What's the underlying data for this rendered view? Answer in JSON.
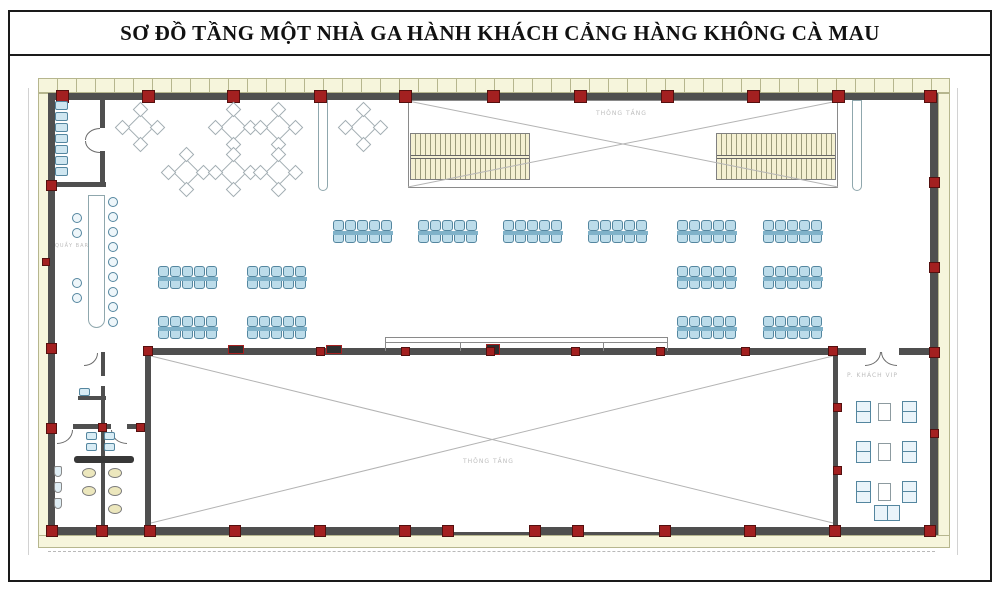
{
  "title": "SƠ ĐỒ TẦNG MỘT NHÀ GA HÀNH KHÁCH CẢNG HÀNG KHÔNG CÀ MAU",
  "colors": {
    "wall": "#4f4f4f",
    "column": "#a32020",
    "column_border": "#55100f",
    "band": "#f6f5dc",
    "band_border": "#b6b68e",
    "seat_fill": "#bcdcea",
    "seat_border": "#54869f",
    "seat_bar": "#80b2c9",
    "table_line": "#a2adb2",
    "stair_fill": "#f4f0d2",
    "stair_line": "#9a9a7a",
    "diagonal": "#b3b3b3",
    "label": "#bdbdbd"
  },
  "labels": [
    {
      "text": "THÔNG TẦNG",
      "x": 596,
      "y": 110,
      "size": 6
    },
    {
      "text": "THÔNG TẦNG",
      "x": 463,
      "y": 458,
      "size": 6
    },
    {
      "text": "P. KHÁCH VIP",
      "x": 847,
      "y": 372,
      "size": 6
    },
    {
      "text": "QUẦY BAR",
      "x": 55,
      "y": 243,
      "size": 5
    }
  ],
  "plan": {
    "benches": [
      [
        333,
        220
      ],
      [
        418,
        220
      ],
      [
        503,
        220
      ],
      [
        588,
        220
      ],
      [
        677,
        220
      ],
      [
        763,
        220
      ],
      [
        158,
        266
      ],
      [
        247,
        266
      ],
      [
        677,
        266
      ],
      [
        763,
        266
      ],
      [
        158,
        316
      ],
      [
        247,
        316
      ],
      [
        677,
        316
      ],
      [
        763,
        316
      ]
    ],
    "cafe_tables": [
      [
        140,
        127
      ],
      [
        233,
        127
      ],
      [
        278,
        127
      ],
      [
        363,
        127
      ],
      [
        186,
        172
      ],
      [
        233,
        172
      ],
      [
        278,
        172
      ]
    ],
    "columns": [
      [
        62,
        96,
        13
      ],
      [
        148,
        96,
        13
      ],
      [
        233,
        96,
        13
      ],
      [
        320,
        96,
        13
      ],
      [
        405,
        96,
        13
      ],
      [
        493,
        96,
        13
      ],
      [
        580,
        96,
        13
      ],
      [
        667,
        96,
        13
      ],
      [
        753,
        96,
        13
      ],
      [
        838,
        96,
        13
      ],
      [
        930,
        96,
        13
      ],
      [
        52,
        531,
        12
      ],
      [
        102,
        531,
        12
      ],
      [
        150,
        531,
        12
      ],
      [
        235,
        531,
        12
      ],
      [
        320,
        531,
        12
      ],
      [
        405,
        531,
        12
      ],
      [
        448,
        531,
        12
      ],
      [
        535,
        531,
        12
      ],
      [
        578,
        531,
        12
      ],
      [
        665,
        531,
        12
      ],
      [
        750,
        531,
        12
      ],
      [
        835,
        531,
        12
      ],
      [
        930,
        531,
        12
      ],
      [
        51,
        185,
        11
      ],
      [
        46,
        262,
        8
      ],
      [
        51,
        348,
        11
      ],
      [
        51,
        428,
        11
      ],
      [
        934,
        182,
        11
      ],
      [
        934,
        267,
        11
      ],
      [
        934,
        352,
        11
      ],
      [
        934,
        433,
        9
      ],
      [
        837,
        407,
        9
      ],
      [
        837,
        470,
        9
      ],
      [
        148,
        351,
        10
      ],
      [
        320,
        351,
        9
      ],
      [
        405,
        351,
        9
      ],
      [
        490,
        351,
        9
      ],
      [
        575,
        351,
        9
      ],
      [
        660,
        351,
        9
      ],
      [
        745,
        351,
        9
      ],
      [
        833,
        351,
        10
      ],
      [
        102,
        427,
        9
      ],
      [
        140,
        427,
        9
      ]
    ],
    "bar_stools": {
      "left_x": 72,
      "left_y": [
        213,
        228,
        278,
        293
      ],
      "right_x": 108,
      "right_y": [
        197,
        212,
        227,
        242,
        257,
        272,
        287,
        302,
        317
      ]
    },
    "seat_rack": {
      "x": 55,
      "y_start": 101,
      "step": 11,
      "count": 7
    },
    "vip": {
      "rows": [
        401,
        441,
        481
      ],
      "chair1_x": 856,
      "table_x": 878,
      "chair2_x": 902,
      "bottom_table": [
        874,
        505
      ]
    },
    "fixtures": {
      "toilets": [
        [
          82,
          468
        ],
        [
          108,
          468
        ],
        [
          82,
          486
        ],
        [
          108,
          486
        ],
        [
          108,
          504
        ]
      ],
      "urinals": [
        [
          54,
          466
        ],
        [
          54,
          482
        ],
        [
          54,
          498
        ]
      ],
      "sinks": [
        [
          86,
          432
        ],
        [
          104,
          432
        ],
        [
          86,
          443
        ],
        [
          104,
          443
        ],
        [
          79,
          388
        ]
      ]
    }
  }
}
